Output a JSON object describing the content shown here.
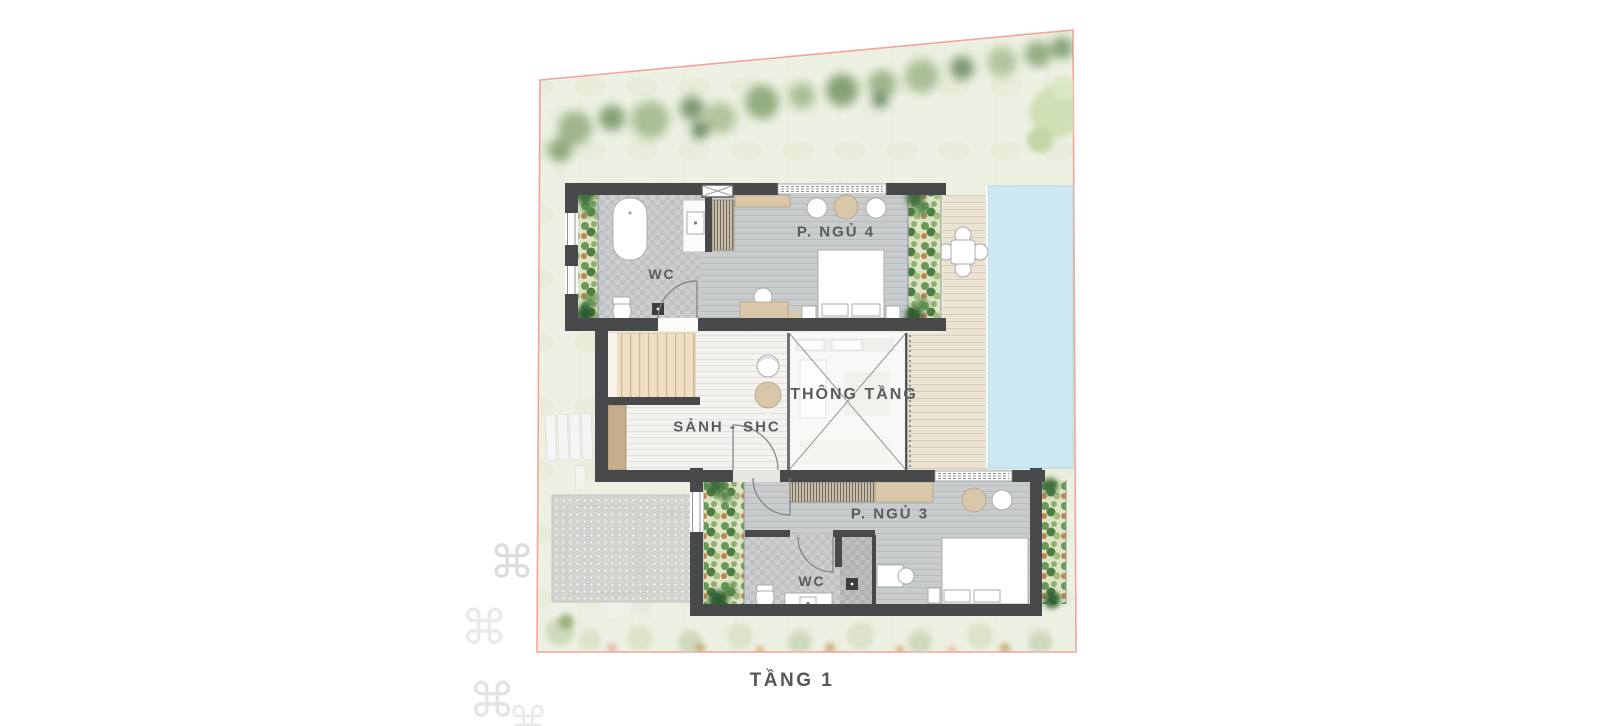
{
  "plan": {
    "floor_title": "TẦNG 1",
    "labels": {
      "bedroom4": "P. NGỦ 4",
      "wc_upper": "WC",
      "void": "THÔNG TẦNG",
      "hall": "SẢNH - SHC",
      "bedroom3": "P. NGỦ 3",
      "wc_lower": "WC"
    },
    "watermark_glyph": "⌘",
    "colors": {
      "boundary": "#f2a49b",
      "wall": "#47494b",
      "pool": "#cde8f2",
      "deck": "#eae2d3",
      "stairs": "#f1dfc3",
      "tile": "#ccced0",
      "bedroom_floor": "#c9cccd",
      "hall_floor": "#f3f2ee",
      "planter": "#dde5c4",
      "furniture_wood": "#d8c7a8",
      "label_text": "#595c5e",
      "site_green": "#edf1e3"
    }
  }
}
